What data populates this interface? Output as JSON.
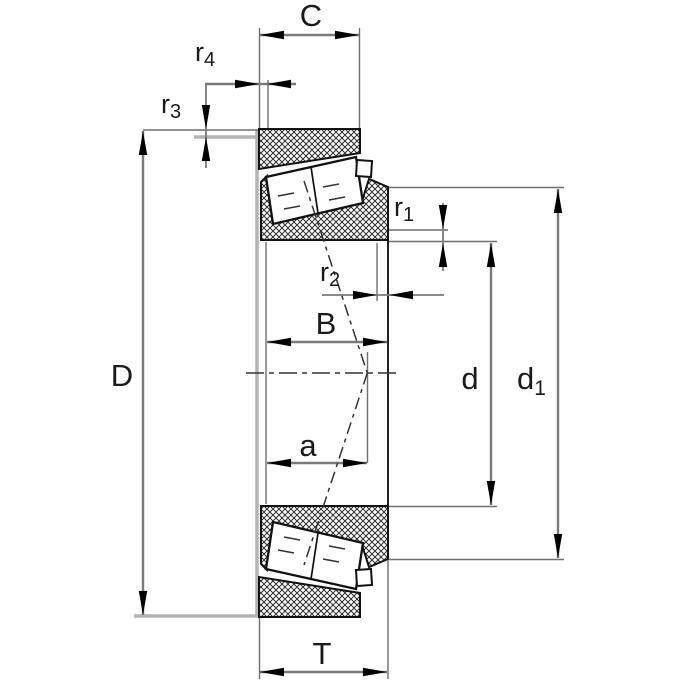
{
  "drawing": {
    "kind": "tapered-roller-bearing-section-drawing",
    "labels": {
      "C": {
        "b": "C",
        "s": ""
      },
      "r4": {
        "b": "r",
        "s": "4"
      },
      "r3": {
        "b": "r",
        "s": "3"
      },
      "D": {
        "b": "D",
        "s": ""
      },
      "B": {
        "b": "B",
        "s": ""
      },
      "a": {
        "b": "a",
        "s": ""
      },
      "T": {
        "b": "T",
        "s": ""
      },
      "r1": {
        "b": "r",
        "s": "1"
      },
      "r2": {
        "b": "r",
        "s": "2"
      },
      "d": {
        "b": "d",
        "s": ""
      },
      "d1": {
        "b": "d",
        "s": "1"
      }
    },
    "colors": {
      "outline": "#1a1a1a",
      "dimension_lines": "#7a7a7a",
      "abutment_gray": "#b4b4b4",
      "background": "#ffffff"
    }
  }
}
